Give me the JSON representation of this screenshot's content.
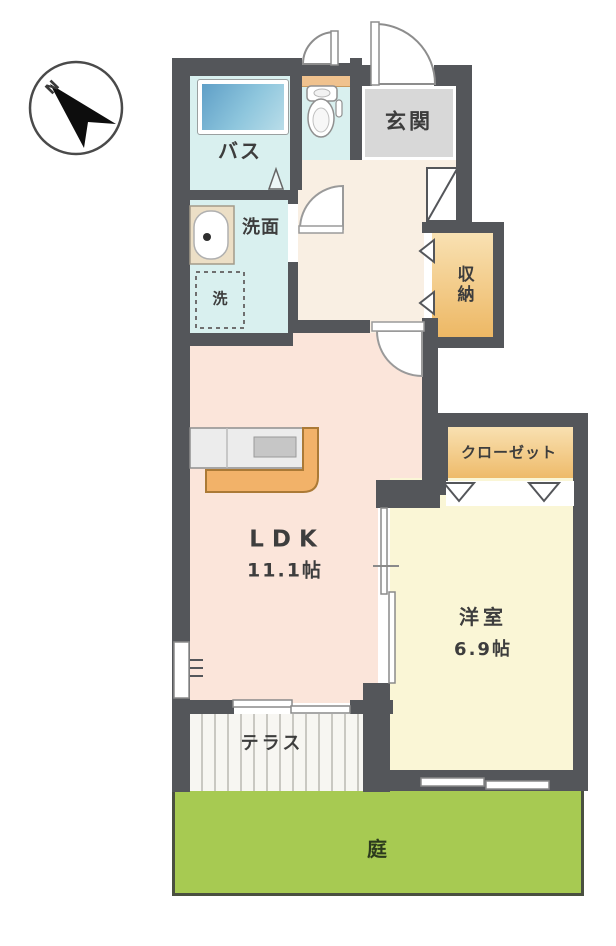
{
  "compass": {
    "north_label": "N"
  },
  "rooms": {
    "bath": {
      "label": "バス"
    },
    "entrance": {
      "label": "玄関"
    },
    "washroom": {
      "label": "洗面"
    },
    "laundry": {
      "label": "洗"
    },
    "storage": {
      "label": "収納"
    },
    "closet": {
      "label": "クローゼット"
    },
    "ldk": {
      "label": "LDK",
      "area": "11.1帖"
    },
    "western_room": {
      "label": "洋室",
      "area": "6.9帖"
    },
    "terrace": {
      "label": "テラス"
    },
    "garden": {
      "label": "庭"
    }
  },
  "colors": {
    "wall": "#54565a",
    "wet_area_floor": "#d9f0ef",
    "entrance_floor": "#d8d8d8",
    "hallway_floor": "#f9efe3",
    "ldk_floor": "#fbe5da",
    "western_room_floor": "#faf6d6",
    "storage_fill_top": "#f9e2b4",
    "storage_fill_bottom": "#edb763",
    "bathtub": "#6aaed2",
    "kitchen_counter_accent": "#f2b269",
    "garden": "#a7ca52"
  }
}
